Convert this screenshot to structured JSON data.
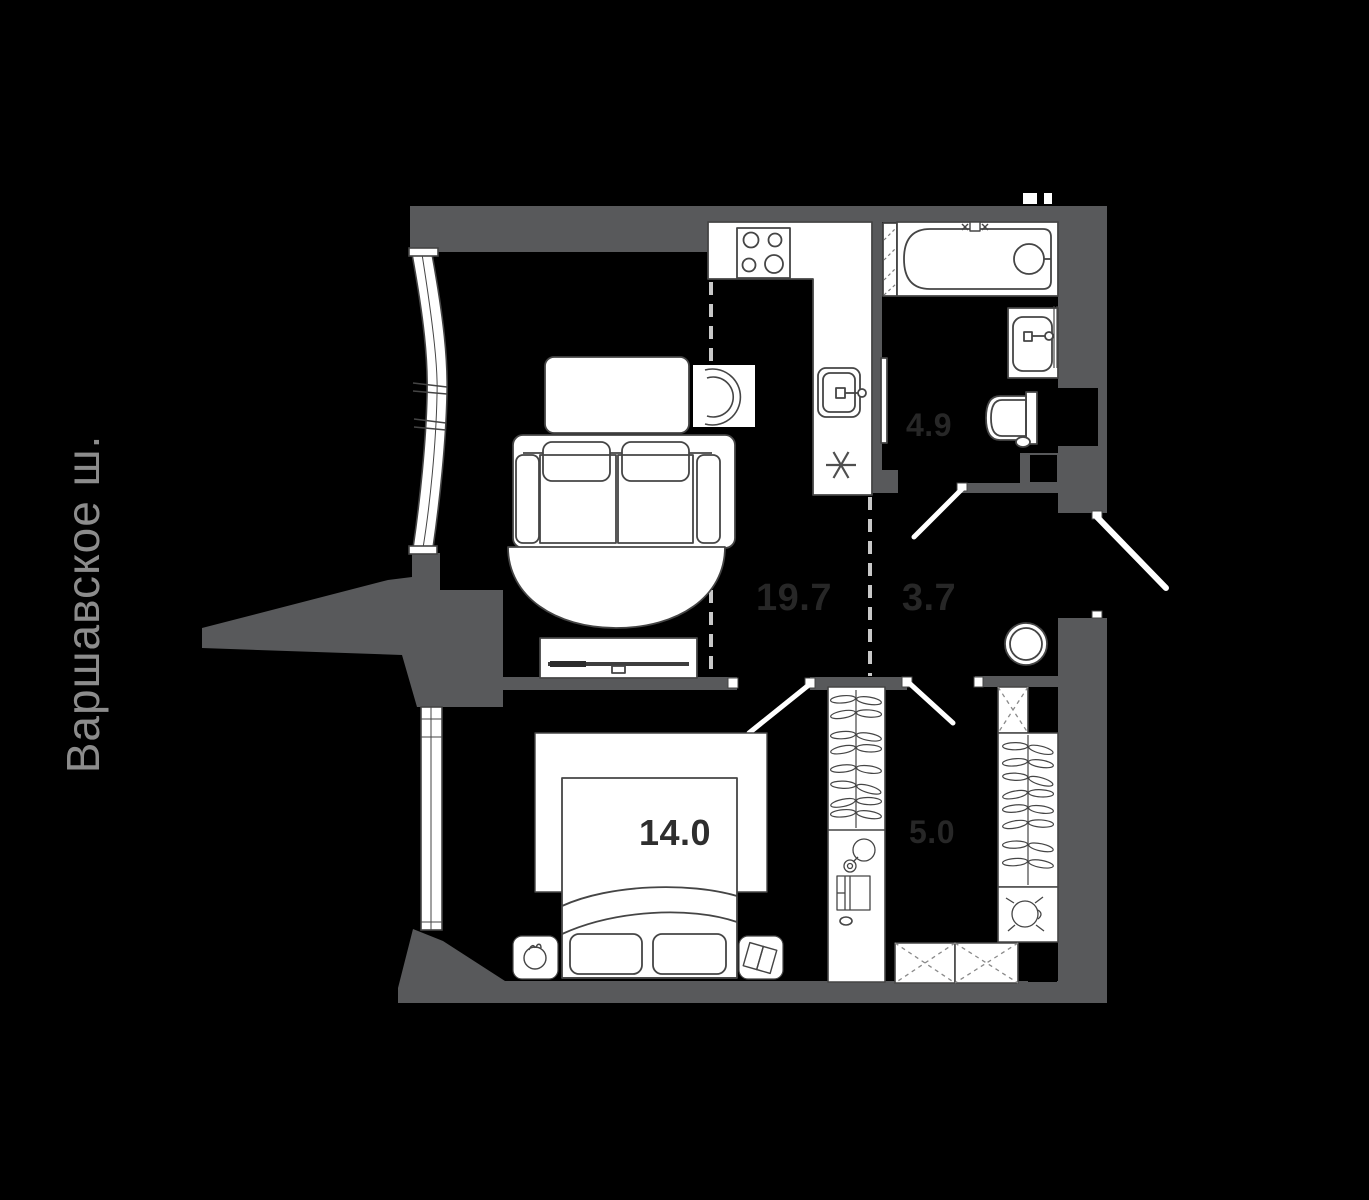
{
  "street_label": "Варшавское ш.",
  "rooms": {
    "living_kitchen": {
      "area": "19.7"
    },
    "hallway": {
      "area": "3.7"
    },
    "bathroom": {
      "area": "4.9"
    },
    "bedroom": {
      "area": "14.0"
    },
    "wardrobe": {
      "area": "5.0"
    }
  },
  "colors": {
    "background": "#000000",
    "wall": "#58595b",
    "furniture_fill": "#ffffff",
    "furniture_line": "#454545",
    "zone_dash": "#c8c8c8",
    "area_label_on_black": "#272727",
    "area_label_on_white": "#2e2e2e",
    "street_label": "#8c8c8c"
  },
  "icons": {
    "fridge": "snowflake-asterisk",
    "stove": "four-burner-hob",
    "bathtub": "tub-with-drain-circle",
    "sink": "basin-with-tap",
    "toilet": "bowl-with-tank",
    "washer_place": "hatched-strip",
    "water_heater": "double-circle",
    "wardrobe": "hanger-rail",
    "shelf": "dashed-cross-box"
  }
}
